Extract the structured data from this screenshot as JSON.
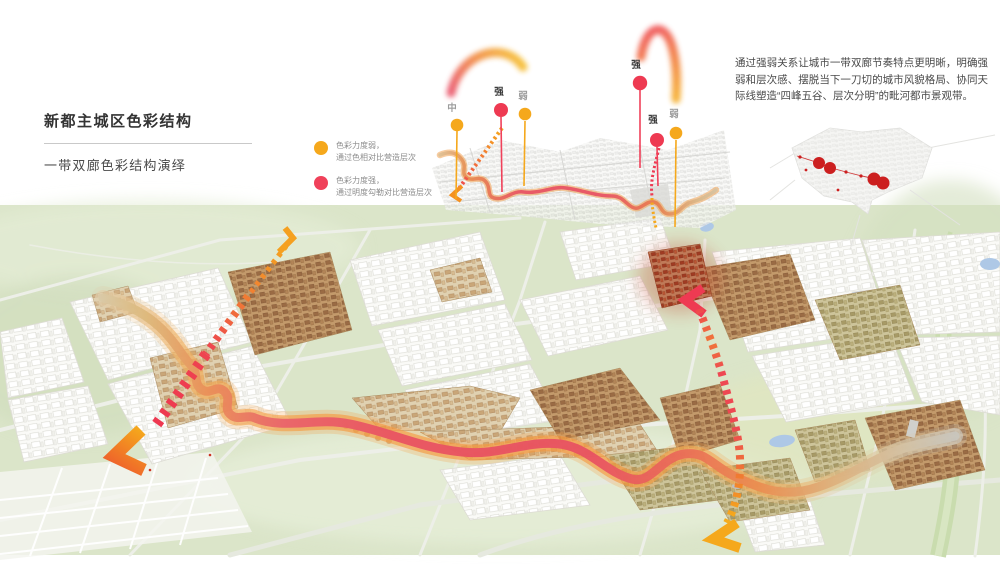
{
  "slide": {
    "title": "新都主城区色彩结构",
    "subtitle": "一带双廊色彩结构演绎",
    "description": "通过强弱关系让城市一带双廊节奏特点更明晰，明确强弱和层次感、摆脱当下一刀切的城市风貌格局、协同天际线塑造“四峰五谷、层次分明”的毗河都市景观带。"
  },
  "legend": {
    "items": [
      {
        "symbol": "yellow-dot",
        "color": "#f5a81c",
        "line1": "色彩力度弱，",
        "line2": "通过色相对比营造层次"
      },
      {
        "symbol": "red-dot",
        "color": "#f0415a",
        "line1": "色彩力度强，",
        "line2": "通过明度勾勒对比营造层次"
      }
    ]
  },
  "rhythm_inset": {
    "pins": [
      {
        "label": "中",
        "level": "medium",
        "color": "#f5a81c"
      },
      {
        "label": "强",
        "level": "strong",
        "color": "#f0415a"
      },
      {
        "label": "弱",
        "level": "weak",
        "color": "#f5a81c"
      },
      {
        "label": "强",
        "level": "strong",
        "color": "#f0415a"
      },
      {
        "label": "强",
        "level": "strong",
        "color": "#f0415a"
      },
      {
        "label": "弱",
        "level": "weak",
        "color": "#f5a81c"
      }
    ]
  },
  "palette": {
    "map_green": "#dbe5c9",
    "ribbon_pink": "#e85565",
    "ribbon_orange": "#f09a40",
    "accent_yellow": "#f5a81c",
    "accent_red": "#f0415a"
  }
}
